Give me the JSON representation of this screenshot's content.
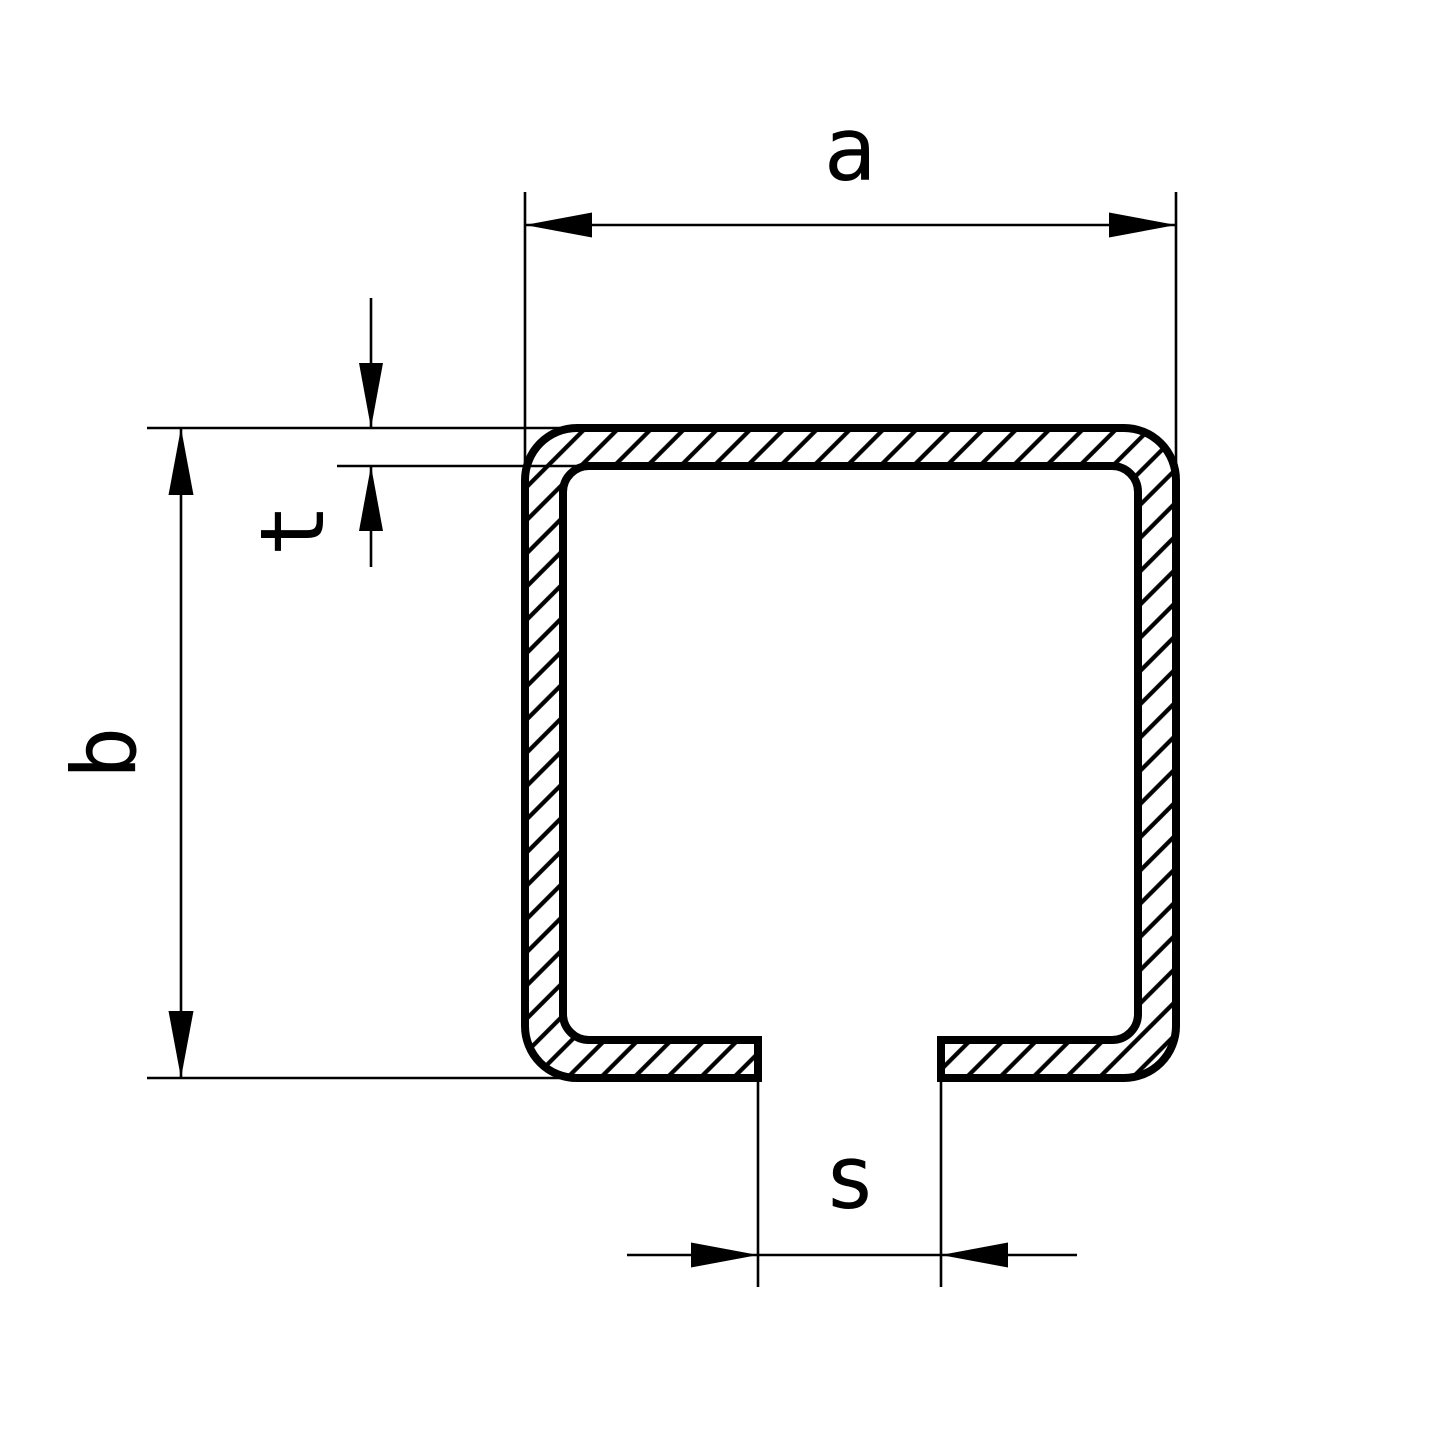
{
  "diagram": {
    "kind": "technical-drawing-c-profile-cross-section",
    "colors": {
      "background": "#ffffff",
      "lines": "#000000"
    },
    "labels": {
      "dim_a": "a",
      "dim_b": "b",
      "dim_t": "t",
      "dim_s": "s"
    }
  }
}
